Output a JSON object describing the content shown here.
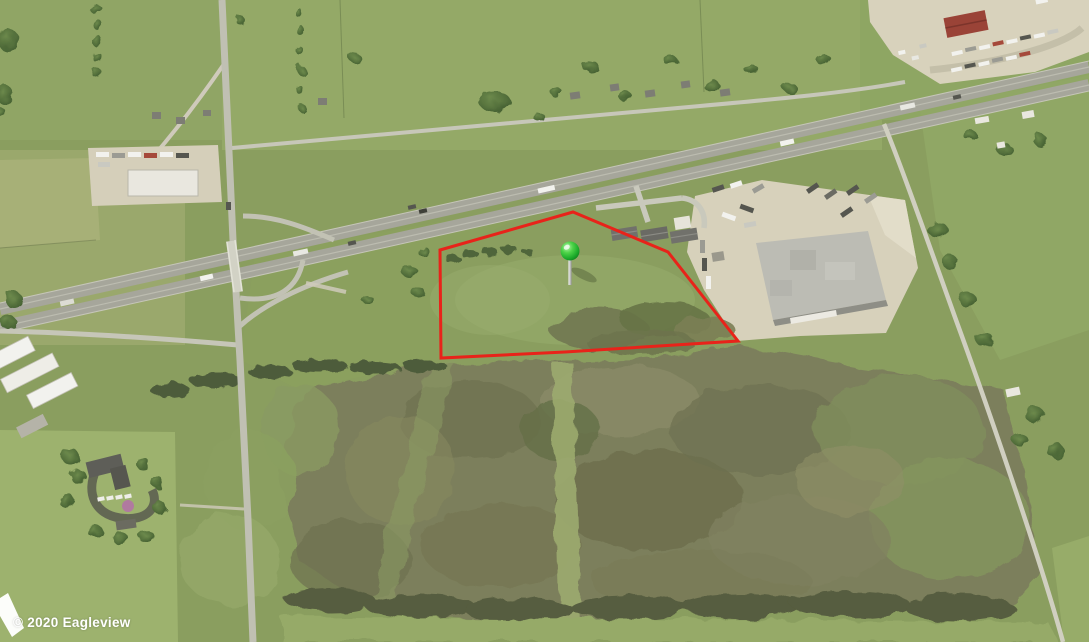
{
  "attribution": {
    "text": "© 2020 Eagleview"
  },
  "annotations": {
    "parcel_outline": {
      "color": "#e8231a",
      "stroke_width": 3,
      "points": [
        [
          440,
          250
        ],
        [
          573,
          212
        ],
        [
          668,
          252
        ],
        [
          738,
          341
        ],
        [
          565,
          352
        ],
        [
          441,
          358
        ]
      ]
    },
    "pin": {
      "x": 570,
      "y": 251,
      "head_color": "#2fbe37",
      "stem_color": "#cccccc"
    }
  }
}
